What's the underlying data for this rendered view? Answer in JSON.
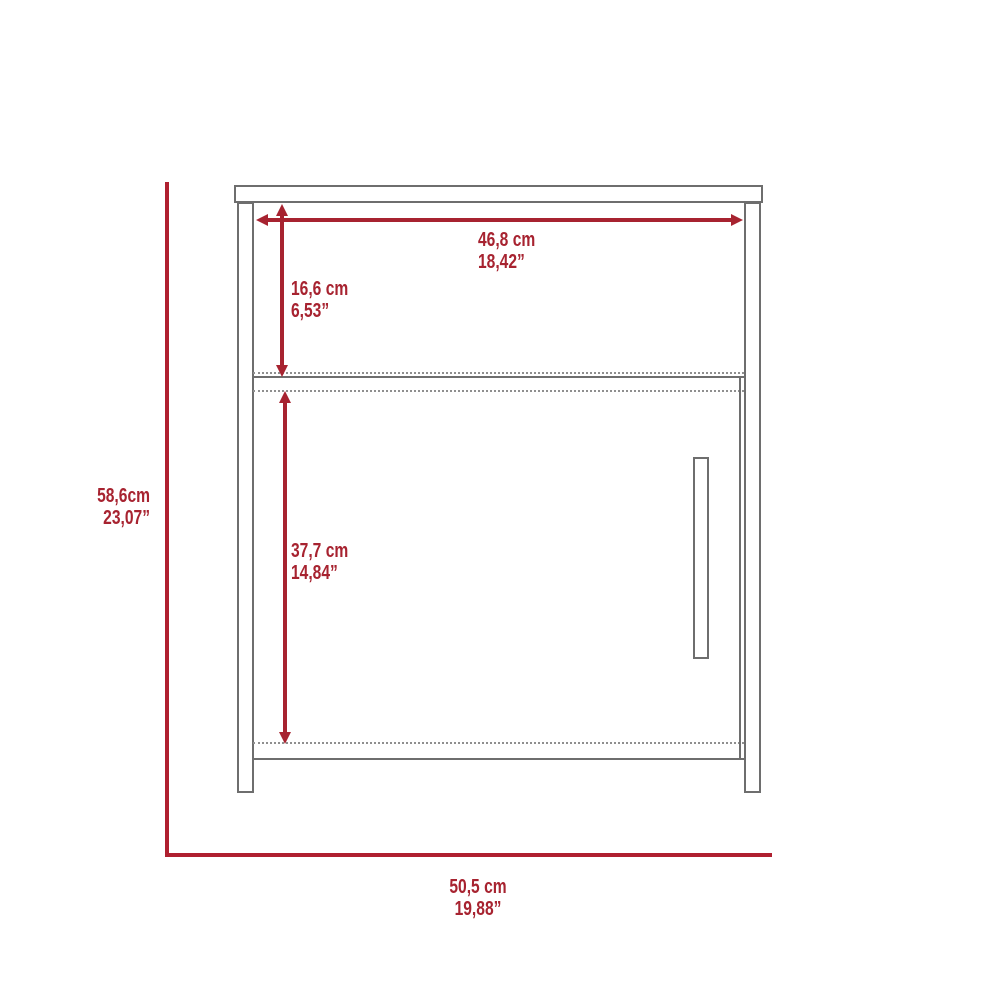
{
  "diagram_title": "nightstand-dimension-diagram",
  "colors": {
    "background": "#FFFFFF",
    "dimension_red": "#A72330",
    "reference_red": "#AF2030",
    "outline_gray": "#6E6E6E",
    "hidden_line_gray": "#8F8F8F"
  },
  "dimensions": {
    "top_width": {
      "cm": "46,8 cm",
      "in": "18,42”"
    },
    "cubby_height": {
      "cm": "16,6 cm",
      "in": "6,53”"
    },
    "door_height": {
      "cm": "37,7 cm",
      "in": "14,84”"
    },
    "overall_height": {
      "cm": "58,6cm",
      "in": "23,07”"
    },
    "overall_width": {
      "cm": "50,5 cm",
      "in": "19,88”"
    }
  }
}
